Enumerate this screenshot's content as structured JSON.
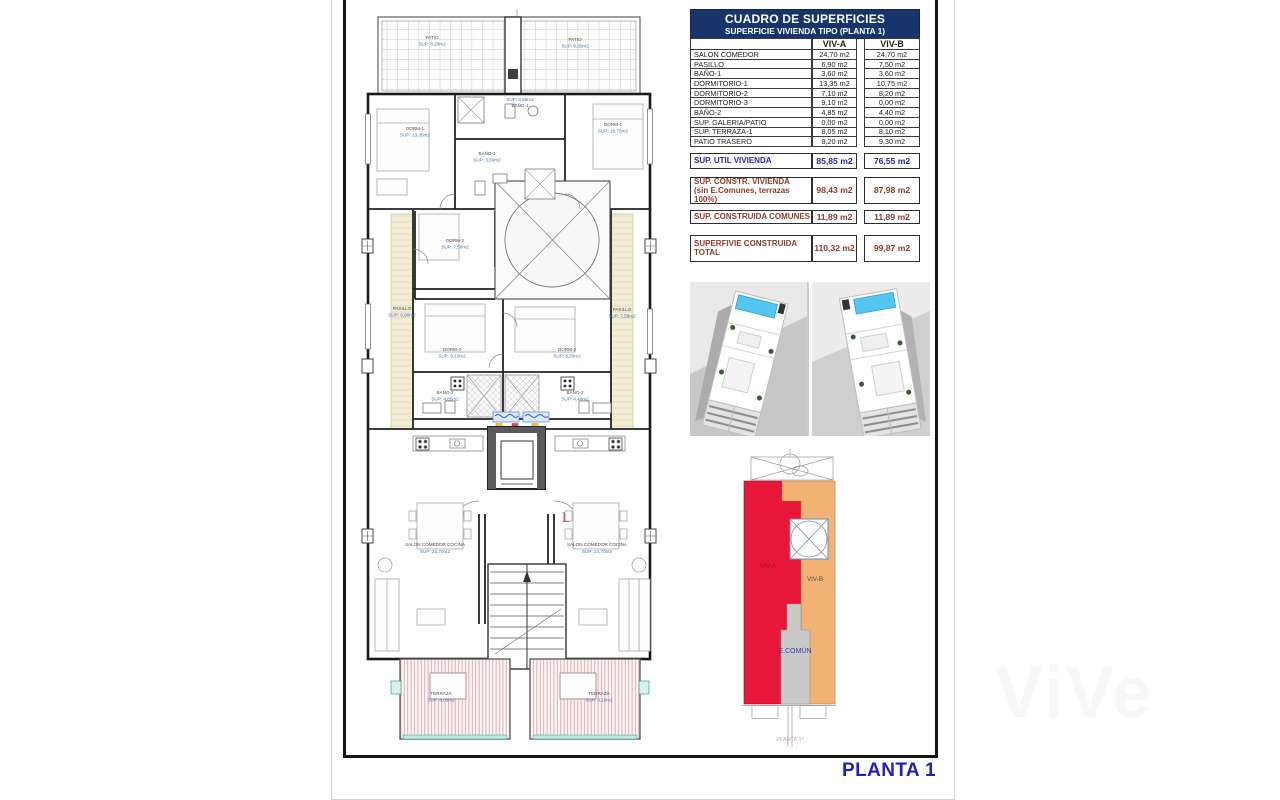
{
  "sheet_title": "PLANTA 1",
  "watermark": "ViVe",
  "colors": {
    "header_navy": "#17356b",
    "accent_blue": "#2626a0",
    "accent_brown": "#8f3a28",
    "plan_sup_blue": "#3f6fc0",
    "unit_red": "#e8173a",
    "unit_orange": "#f2b274",
    "comun_gray": "#c9c9c9",
    "title_blue": "#2020c0",
    "letter_red": "#c42828",
    "pool_blue": "#53c6f2"
  },
  "table": {
    "title": "CUADRO DE SUPERFICIES",
    "subtitle": "SUPERFICIE VIVIENDA TIPO  (PLANTA 1)",
    "col_a": "VIV-A",
    "col_b": "VIV-B",
    "rows": [
      {
        "label": "SALON COMEDOR",
        "a": "24,70 m2",
        "b": "24,70 m2"
      },
      {
        "label": "PASILLO",
        "a": "6,90 m2",
        "b": "7,50 m2"
      },
      {
        "label": "BAÑO-1",
        "a": "3,60 m2",
        "b": "3,60 m2"
      },
      {
        "label": "DORMITORIO-1",
        "a": "13,35 m2",
        "b": "10,75 m2"
      },
      {
        "label": "DORMITORIO-2",
        "a": "7,10 m2",
        "b": "8,20 m2"
      },
      {
        "label": "DORMITORIO-3",
        "a": "9,10 m2",
        "b": "0,00 m2"
      },
      {
        "label": "BAÑO-2",
        "a": "4,85 m2",
        "b": "4,40 m2"
      },
      {
        "label": "SUP. GALERIA/PATIO",
        "a": "0,00 m2",
        "b": "0,00 m2"
      },
      {
        "label": "SUP. TERRAZA-1",
        "a": "8,05 m2",
        "b": "8,10 m2"
      },
      {
        "label": "PATIO TRASERO",
        "a": "8,20 m2",
        "b": "9,30 m2"
      }
    ],
    "summary": [
      {
        "label": "SUP. UTIL VIVIENDA",
        "label2": "",
        "a": "85,85 m2",
        "b": "76,55 m2",
        "accent": "blue",
        "h": "sum-h15",
        "gap": "mt6"
      },
      {
        "label": "SUP. CONSTR. VIVIENDA",
        "label2": "(sin E.Comunes, terrazas 100%)",
        "a": "98,43 m2",
        "b": "87,98 m2",
        "accent": "brown",
        "h": "sum-h26",
        "gap": "mt8"
      },
      {
        "label": "SUP. CONSTRUIDA COMUNES",
        "label2": "",
        "a": "11,89 m2",
        "b": "11,89 m2",
        "accent": "brown",
        "h": "sum-h13",
        "gap": "mt6"
      },
      {
        "label": "SUPERFIVIE CONSTRUIDA",
        "label2": "TOTAL",
        "a": "110,32 m2",
        "b": "99,87 m2",
        "accent": "brown",
        "h": "sum-h26",
        "gap": "mt10"
      }
    ]
  },
  "plan": {
    "unit_a": "A",
    "unit_b": "B",
    "labels": [
      {
        "name": "PATIO",
        "sup": "SUP: 8,20m2"
      },
      {
        "name": "PATIO",
        "sup": "SUP: 9,30m2"
      },
      {
        "name": "BAÑO-1",
        "sup": "SUP: 3,60m2"
      },
      {
        "name": "DORM-1",
        "sup": "SUP: 13,35m2"
      },
      {
        "name": "DORM-1",
        "sup": "SUP: 10,75m2"
      },
      {
        "name": "BAÑO-1",
        "sup": "SUP: 3,60m2"
      },
      {
        "name": "DORM-2",
        "sup": "SUP: 7,50m2"
      },
      {
        "name": "PASILLO",
        "sup": "SUP: 6,90m2"
      },
      {
        "name": "PASILLO",
        "sup": "SUP: 7,58m2"
      },
      {
        "name": "DORM-3",
        "sup": "SUP: 9,10m2"
      },
      {
        "name": "DORM-2",
        "sup": "SUP: 8,20m2"
      },
      {
        "name": "BAÑO-2",
        "sup": "SUP: 4,85m2"
      },
      {
        "name": "BAÑO-2",
        "sup": "SUP: 4,40m2"
      },
      {
        "name": "SALON COMEDOR COCINA",
        "sup": "SUP: 24,70m2"
      },
      {
        "name": "SALON COMEDOR COCINA",
        "sup": "SUP: 24,70m2"
      },
      {
        "name": "TERRAZA",
        "sup": "SUP: 8,05m2"
      },
      {
        "name": "TERRAZA",
        "sup": "SUP: 8,10m2"
      }
    ]
  },
  "diagram": {
    "viv_a": "VIV-A",
    "viv_b": "VIV-B",
    "comun": "E.COMÚN",
    "caption": "PLANTA 1ª"
  }
}
